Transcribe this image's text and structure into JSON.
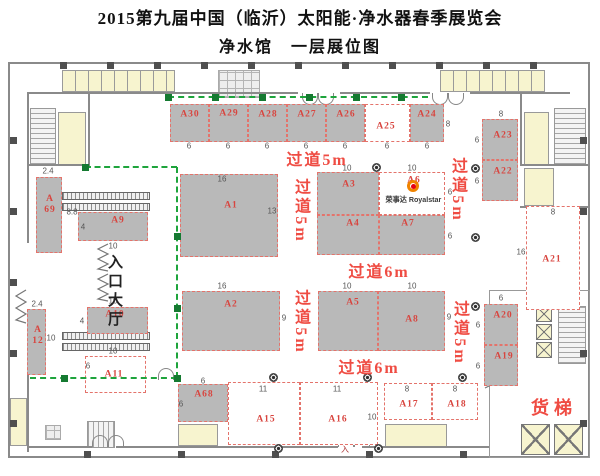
{
  "title": "2015第九届中国（临沂）太阳能·净水器春季展览会",
  "subtitle": "净水馆　一层展位图",
  "labels": {
    "entrance": "入口大厅",
    "freight": "货梯",
    "door_mark": "入"
  },
  "royalstar": {
    "cn": "荣事达",
    "en": "Royalstar"
  },
  "colors": {
    "booth_fill": "#b9b9b9",
    "booth_dash": "#e4736b",
    "label_red": "#d8453f",
    "aisle_red": "#ef4c43",
    "dim_gray": "#555555",
    "path_green": "#1ea43c",
    "room_yellow": "#f7f4cf",
    "wall_gray": "#8a8a8a",
    "logo_orange": "#f08300",
    "logo_red": "#e60012"
  },
  "plan": {
    "booths": [
      {
        "id": "A30",
        "x": 170,
        "y": 104,
        "w": 39,
        "h": 38,
        "fill": "gray",
        "lx": 19,
        "ly": 10
      },
      {
        "id": "A29",
        "x": 209,
        "y": 104,
        "w": 39,
        "h": 38,
        "fill": "gray",
        "lx": 19,
        "ly": 9
      },
      {
        "id": "A28",
        "x": 248,
        "y": 104,
        "w": 39,
        "h": 38,
        "fill": "gray",
        "lx": 19,
        "ly": 10
      },
      {
        "id": "A27",
        "x": 287,
        "y": 104,
        "w": 39,
        "h": 38,
        "fill": "gray",
        "lx": 19,
        "ly": 10
      },
      {
        "id": "A26",
        "x": 326,
        "y": 104,
        "w": 39,
        "h": 38,
        "fill": "gray",
        "lx": 19,
        "ly": 10
      },
      {
        "id": "A25",
        "x": 365,
        "y": 104,
        "w": 45,
        "h": 38,
        "fill": "white",
        "lx": 20,
        "ly": 22
      },
      {
        "id": "A24",
        "x": 410,
        "y": 104,
        "w": 34,
        "h": 38,
        "fill": "gray",
        "lx": 16,
        "ly": 10
      },
      {
        "id": "A69",
        "x": 36,
        "y": 177,
        "w": 26,
        "h": 76,
        "fill": "gray",
        "lx": 13,
        "ly": 27,
        "two_line": true
      },
      {
        "id": "A9",
        "x": 78,
        "y": 212,
        "w": 70,
        "h": 29,
        "fill": "gray",
        "lx": 39,
        "ly": 8
      },
      {
        "id": "A1",
        "x": 180,
        "y": 174,
        "w": 98,
        "h": 83,
        "fill": "gray",
        "lx": 50,
        "ly": 31
      },
      {
        "id": "A3",
        "x": 317,
        "y": 172,
        "w": 62,
        "h": 43,
        "fill": "gray",
        "lx": 31,
        "ly": 12
      },
      {
        "id": "A6",
        "x": 379,
        "y": 172,
        "w": 66,
        "h": 43,
        "fill": "white",
        "lx": 34,
        "ly": 8
      },
      {
        "id": "A4",
        "x": 317,
        "y": 215,
        "w": 62,
        "h": 40,
        "fill": "gray",
        "lx": 35,
        "ly": 8
      },
      {
        "id": "A7",
        "x": 379,
        "y": 215,
        "w": 66,
        "h": 40,
        "fill": "gray",
        "lx": 28,
        "ly": 8
      },
      {
        "id": "A2",
        "x": 182,
        "y": 291,
        "w": 98,
        "h": 60,
        "fill": "gray",
        "lx": 48,
        "ly": 13
      },
      {
        "id": "A5",
        "x": 318,
        "y": 291,
        "w": 60,
        "h": 60,
        "fill": "gray",
        "lx": 34,
        "ly": 11
      },
      {
        "id": "A8",
        "x": 378,
        "y": 291,
        "w": 67,
        "h": 60,
        "fill": "gray",
        "lx": 33,
        "ly": 28
      },
      {
        "id": "A23",
        "x": 482,
        "y": 119,
        "w": 36,
        "h": 41,
        "fill": "gray",
        "lx": 20,
        "ly": 16
      },
      {
        "id": "A22",
        "x": 482,
        "y": 160,
        "w": 36,
        "h": 41,
        "fill": "gray",
        "lx": 20,
        "ly": 11
      },
      {
        "id": "A21",
        "x": 526,
        "y": 206,
        "w": 54,
        "h": 104,
        "fill": "white",
        "lx": 25,
        "ly": 53
      },
      {
        "id": "A20",
        "x": 484,
        "y": 304,
        "w": 34,
        "h": 41,
        "fill": "gray",
        "lx": 18,
        "ly": 11
      },
      {
        "id": "A19",
        "x": 484,
        "y": 345,
        "w": 34,
        "h": 41,
        "fill": "gray",
        "lx": 19,
        "ly": 11
      },
      {
        "id": "A12",
        "x": 27,
        "y": 309,
        "w": 19,
        "h": 66,
        "fill": "gray",
        "lx": 10,
        "ly": 26,
        "two_line": true
      },
      {
        "id": "A10",
        "x": 87,
        "y": 307,
        "w": 61,
        "h": 27,
        "fill": "gray",
        "lx": 27,
        "ly": 7
      },
      {
        "id": "A11",
        "x": 85,
        "y": 356,
        "w": 61,
        "h": 37,
        "fill": "white",
        "lx": 28,
        "ly": 18
      },
      {
        "id": "A68",
        "x": 178,
        "y": 384,
        "w": 50,
        "h": 38,
        "fill": "gray",
        "lx": 25,
        "ly": 10
      },
      {
        "id": "A15",
        "x": 228,
        "y": 382,
        "w": 72,
        "h": 63,
        "fill": "white",
        "lx": 37,
        "ly": 37
      },
      {
        "id": "A16",
        "x": 300,
        "y": 382,
        "w": 78,
        "h": 63,
        "fill": "white",
        "lx": 37,
        "ly": 37
      },
      {
        "id": "A17",
        "x": 384,
        "y": 383,
        "w": 48,
        "h": 37,
        "fill": "white",
        "lx": 24,
        "ly": 21
      },
      {
        "id": "A18",
        "x": 432,
        "y": 383,
        "w": 46,
        "h": 37,
        "fill": "white",
        "lx": 24,
        "ly": 21
      }
    ],
    "dims": [
      {
        "t": "6",
        "x": 189,
        "y": 146
      },
      {
        "t": "6",
        "x": 228,
        "y": 146
      },
      {
        "t": "6",
        "x": 267,
        "y": 146
      },
      {
        "t": "6",
        "x": 306,
        "y": 146
      },
      {
        "t": "6",
        "x": 345,
        "y": 146
      },
      {
        "t": "6",
        "x": 387,
        "y": 146
      },
      {
        "t": "6",
        "x": 427,
        "y": 146
      },
      {
        "t": "8",
        "x": 448,
        "y": 124
      },
      {
        "t": "8",
        "x": 501,
        "y": 114
      },
      {
        "t": "6",
        "x": 477,
        "y": 140
      },
      {
        "t": "6",
        "x": 477,
        "y": 181
      },
      {
        "t": "8",
        "x": 553,
        "y": 212
      },
      {
        "t": "16",
        "x": 521,
        "y": 252
      },
      {
        "t": "6",
        "x": 501,
        "y": 298
      },
      {
        "t": "6",
        "x": 478,
        "y": 325
      },
      {
        "t": "6",
        "x": 478,
        "y": 366
      },
      {
        "t": "16",
        "x": 222,
        "y": 179
      },
      {
        "t": "13",
        "x": 272,
        "y": 211
      },
      {
        "t": "10",
        "x": 347,
        "y": 168
      },
      {
        "t": "10",
        "x": 412,
        "y": 168
      },
      {
        "t": "6",
        "x": 450,
        "y": 192
      },
      {
        "t": "6",
        "x": 450,
        "y": 236
      },
      {
        "t": "16",
        "x": 222,
        "y": 286
      },
      {
        "t": "9",
        "x": 284,
        "y": 318
      },
      {
        "t": "10",
        "x": 347,
        "y": 286
      },
      {
        "t": "10",
        "x": 412,
        "y": 286
      },
      {
        "t": "9",
        "x": 449,
        "y": 317
      },
      {
        "t": "2.4",
        "x": 48,
        "y": 171
      },
      {
        "t": "8.8",
        "x": 72,
        "y": 212
      },
      {
        "t": "4",
        "x": 83,
        "y": 227
      },
      {
        "t": "10",
        "x": 113,
        "y": 246
      },
      {
        "t": "2.4",
        "x": 37,
        "y": 304
      },
      {
        "t": "10",
        "x": 51,
        "y": 338
      },
      {
        "t": "10",
        "x": 113,
        "y": 301
      },
      {
        "t": "4",
        "x": 82,
        "y": 321
      },
      {
        "t": "10",
        "x": 113,
        "y": 351
      },
      {
        "t": "6",
        "x": 88,
        "y": 366
      },
      {
        "t": "6",
        "x": 203,
        "y": 381
      },
      {
        "t": "6",
        "x": 181,
        "y": 404
      },
      {
        "t": "11",
        "x": 263,
        "y": 389
      },
      {
        "t": "11",
        "x": 337,
        "y": 389
      },
      {
        "t": "10",
        "x": 372,
        "y": 417
      },
      {
        "t": "8",
        "x": 407,
        "y": 389
      },
      {
        "t": "8",
        "x": 455,
        "y": 389
      }
    ],
    "aisles": [
      {
        "t": "过道5m",
        "x": 317,
        "y": 158,
        "vert": false
      },
      {
        "t": "过道5m",
        "x": 300,
        "y": 211,
        "vert": true
      },
      {
        "t": "过道5m",
        "x": 457,
        "y": 190,
        "vert": true
      },
      {
        "t": "过道6m",
        "x": 379,
        "y": 270,
        "vert": false
      },
      {
        "t": "过道5m",
        "x": 300,
        "y": 322,
        "vert": true
      },
      {
        "t": "过道5m",
        "x": 459,
        "y": 333,
        "vert": true
      },
      {
        "t": "过道6m",
        "x": 369,
        "y": 366,
        "vert": false
      }
    ],
    "green_segments": [
      {
        "x1": 168,
        "y1": 97,
        "x2": 428,
        "y2": 97
      },
      {
        "x1": 85,
        "y1": 167,
        "x2": 177,
        "y2": 167
      },
      {
        "x1": 177,
        "y1": 167,
        "x2": 177,
        "y2": 378
      },
      {
        "x1": 30,
        "y1": 378,
        "x2": 177,
        "y2": 378
      }
    ],
    "green_markers": [
      [
        168,
        97
      ],
      [
        215,
        97
      ],
      [
        262,
        97
      ],
      [
        309,
        97
      ],
      [
        356,
        97
      ],
      [
        401,
        97
      ],
      [
        85,
        167
      ],
      [
        177,
        236
      ],
      [
        177,
        308
      ],
      [
        177,
        378
      ],
      [
        64,
        378
      ]
    ],
    "columns": [
      [
        376,
        167
      ],
      [
        475,
        168
      ],
      [
        475,
        237
      ],
      [
        273,
        377
      ],
      [
        367,
        377
      ],
      [
        462,
        377
      ],
      [
        278,
        448
      ],
      [
        378,
        448
      ],
      [
        475,
        306
      ]
    ]
  }
}
